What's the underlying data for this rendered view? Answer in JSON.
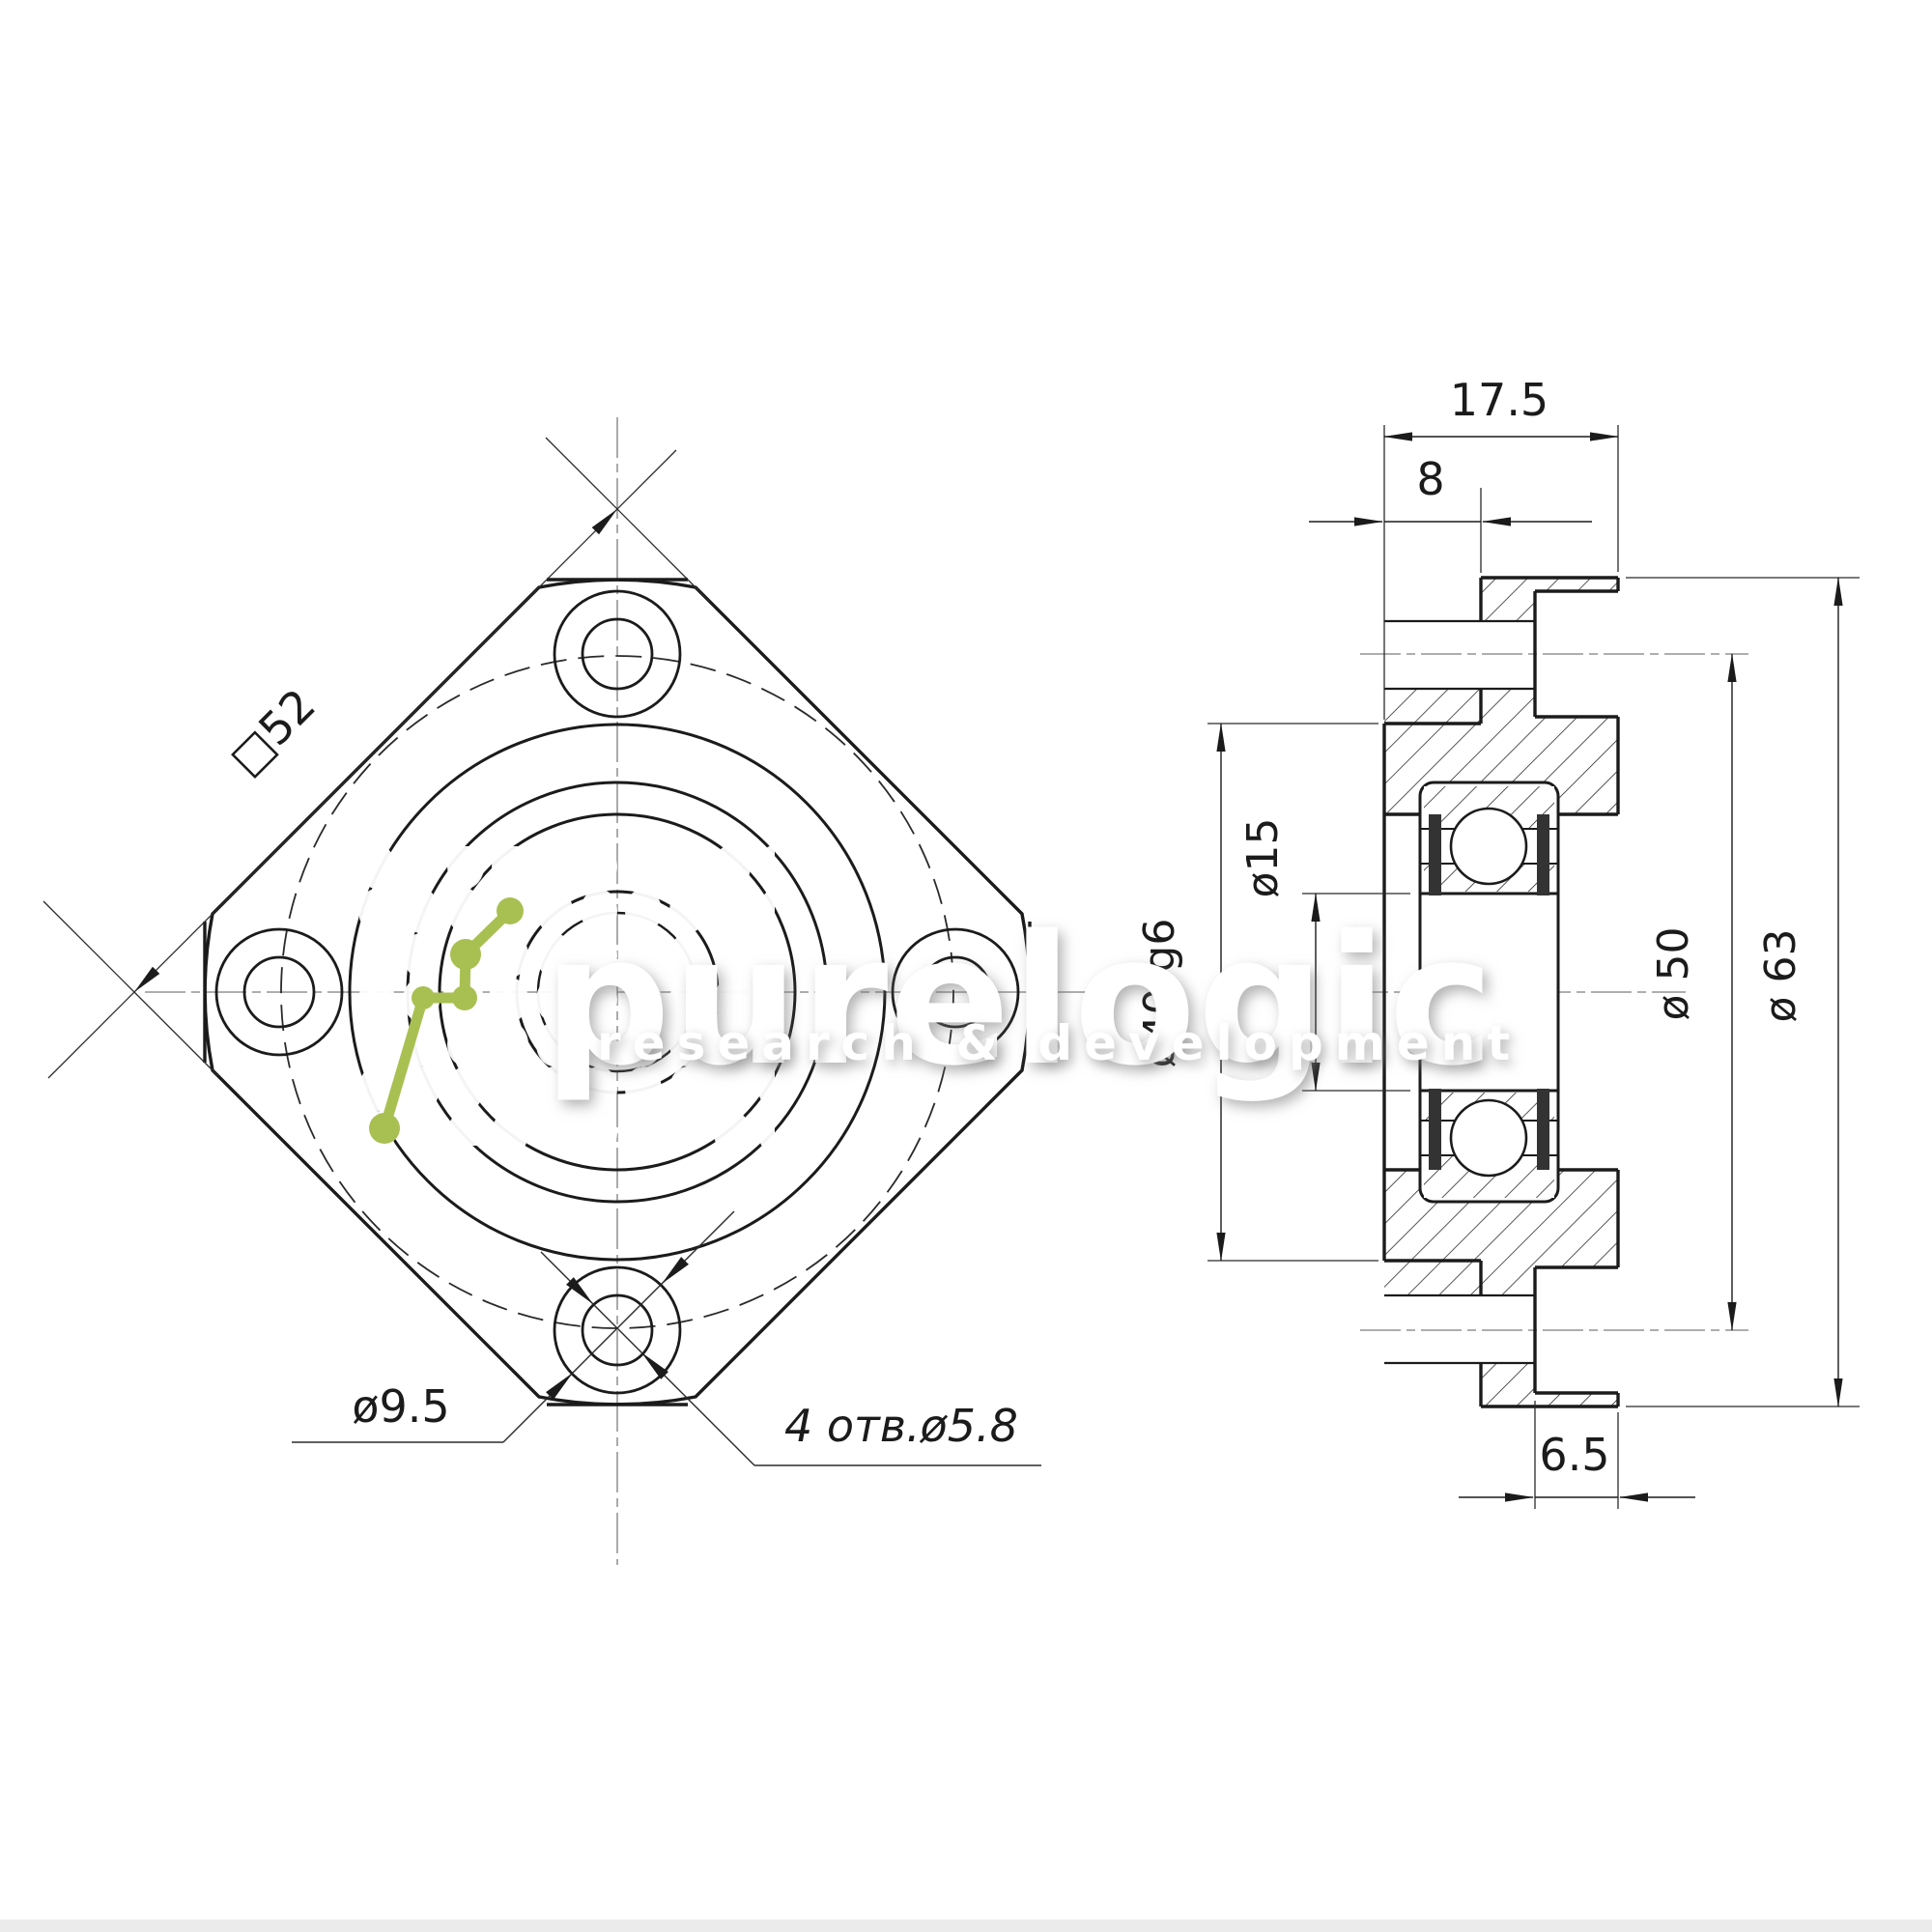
{
  "front_view": {
    "square_side_label": "□52",
    "counterbore_label": "ø9.5",
    "holes_label": "4 отв.ø5.8"
  },
  "side_view": {
    "total_width_label": "17.5",
    "spigot_length_label": "8",
    "counterbore_depth_label": "6.5",
    "bore_label": "ø15",
    "spigot_dia_label": "ø40-g6",
    "bolt_circle_label": "ø 50",
    "outer_dia_label": "ø 63"
  },
  "watermark": {
    "brand": "purelogic",
    "subtitle": "research & development",
    "accent_color": "#a8c052"
  }
}
